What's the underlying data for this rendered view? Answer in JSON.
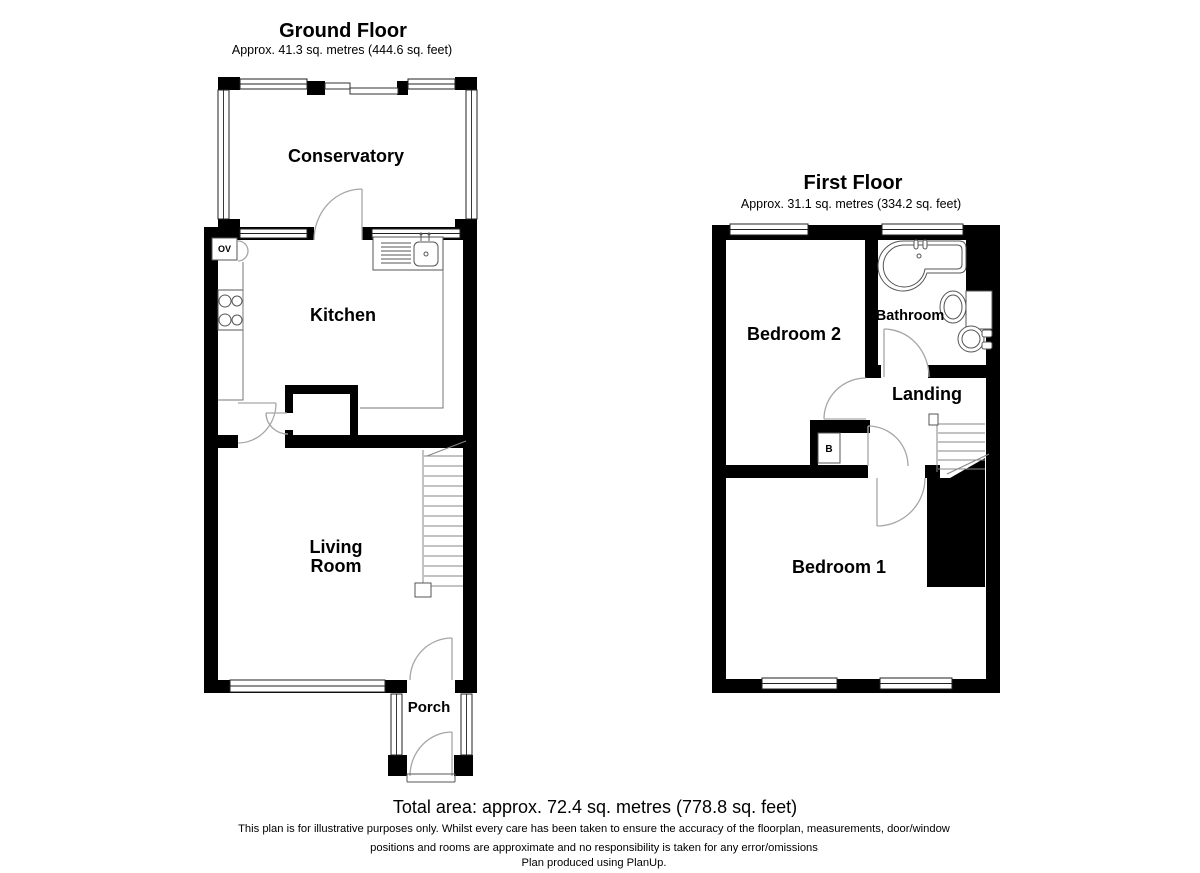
{
  "ground_floor": {
    "title": "Ground Floor",
    "subtitle": "Approx. 41.3 sq. metres (444.6 sq. feet)",
    "rooms": {
      "conservatory": "Conservatory",
      "kitchen": "Kitchen",
      "living_room_line1": "Living",
      "living_room_line2": "Room",
      "porch": "Porch"
    },
    "fixtures": {
      "oven_label": "OV"
    }
  },
  "first_floor": {
    "title": "First Floor",
    "subtitle": "Approx. 31.1 sq. metres (334.2 sq. feet)",
    "rooms": {
      "bedroom2": "Bedroom 2",
      "bathroom": "Bathroom",
      "landing": "Landing",
      "bedroom1": "Bedroom 1"
    },
    "fixtures": {
      "boiler_label": "B"
    }
  },
  "footer": {
    "total_area": "Total area: approx. 72.4 sq. metres (778.8 sq. feet)",
    "disclaimer_line1": "This plan is for illustrative purposes only. Whilst every care has been taken to ensure the accuracy of the floorplan, measurements, door/window",
    "disclaimer_line2": "positions and rooms are approximate and no responsibility is taken for any error/omissions",
    "disclaimer_line3": "Plan produced using PlanUp."
  },
  "colors": {
    "background": "#ffffff",
    "walls": "#000000",
    "fixture_lines": "#555555",
    "door_arcs": "#a6a6a6",
    "text": "#000000"
  }
}
